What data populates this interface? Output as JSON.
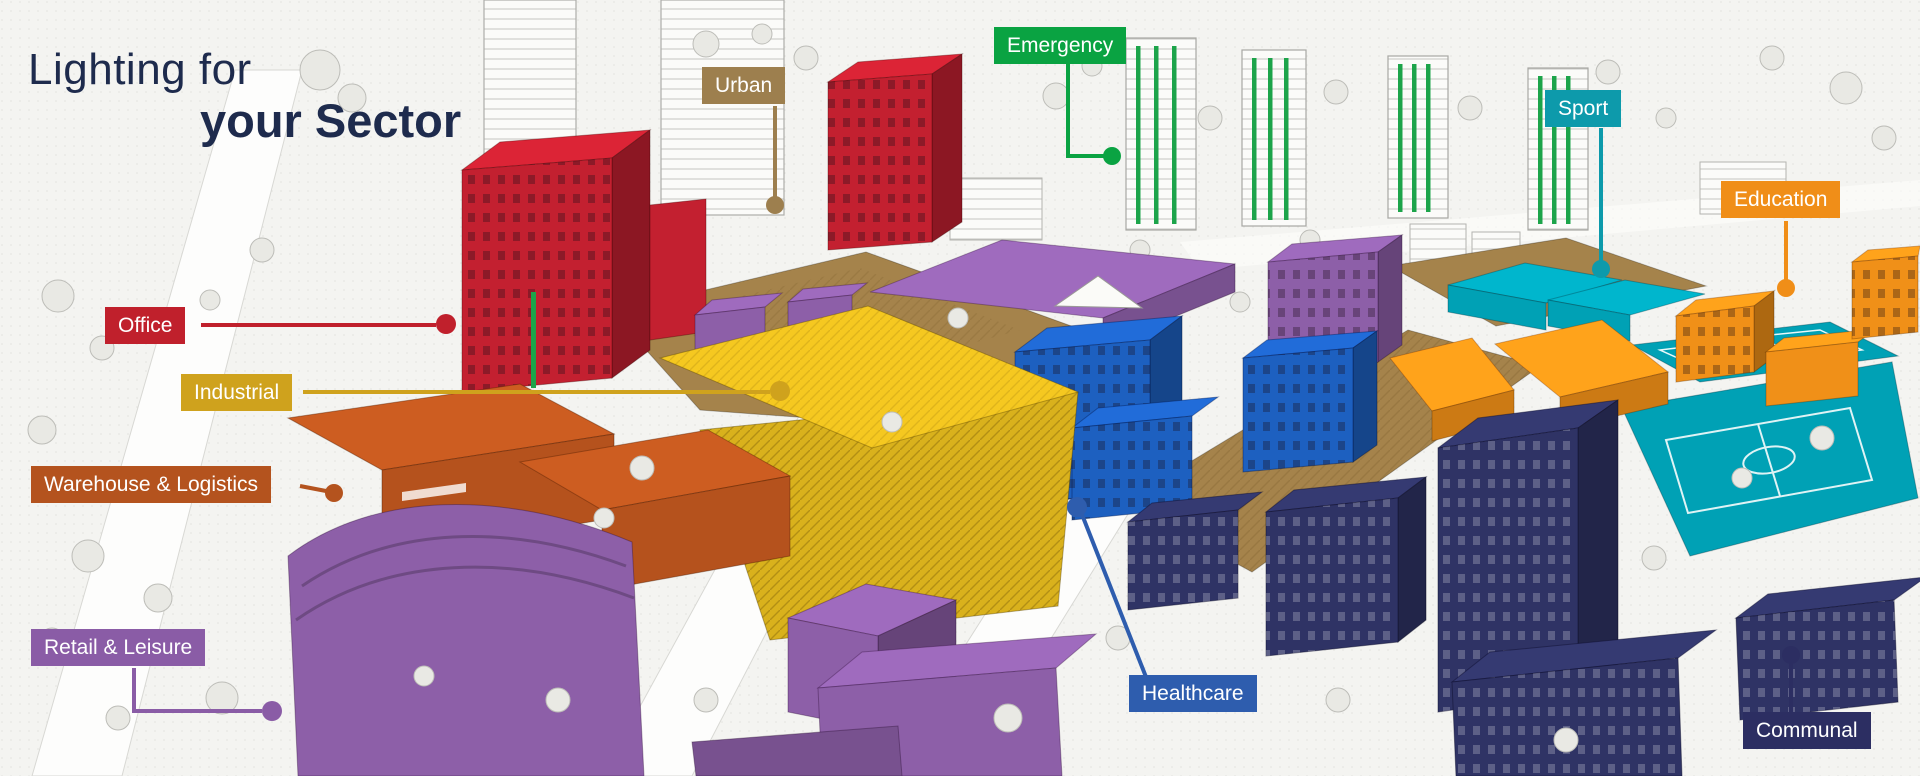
{
  "title": {
    "line1": "Lighting for",
    "line2": "your Sector",
    "color": "#1e2b4d"
  },
  "canvas": {
    "background": "#f4f4f1"
  },
  "sectors": [
    {
      "name": "Office",
      "label_color": "#c0202c",
      "building_color": "#c32030"
    },
    {
      "name": "Industrial",
      "label_color": "#cfa21d",
      "building_color": "#d9b11c"
    },
    {
      "name": "Warehouse & Logistics",
      "label_color": "#b4531e",
      "building_color": "#b5521d"
    },
    {
      "name": "Retail & Leisure",
      "label_color": "#8a5ca6",
      "building_color": "#8d5fa8"
    },
    {
      "name": "Urban",
      "label_color": "#9d7f4e",
      "building_color": "#a5834b"
    },
    {
      "name": "Emergency",
      "label_color": "#0aa342",
      "building_color": "#1ca44a"
    },
    {
      "name": "Sport",
      "label_color": "#0d9aab",
      "building_color": "#00a1b5"
    },
    {
      "name": "Education",
      "label_color": "#f08e18",
      "building_color": "#f09018"
    },
    {
      "name": "Healthcare",
      "label_color": "#2e5dae",
      "building_color": "#1d60c0"
    },
    {
      "name": "Communal",
      "label_color": "#2c2e62",
      "building_color": "#2f3365"
    }
  ]
}
